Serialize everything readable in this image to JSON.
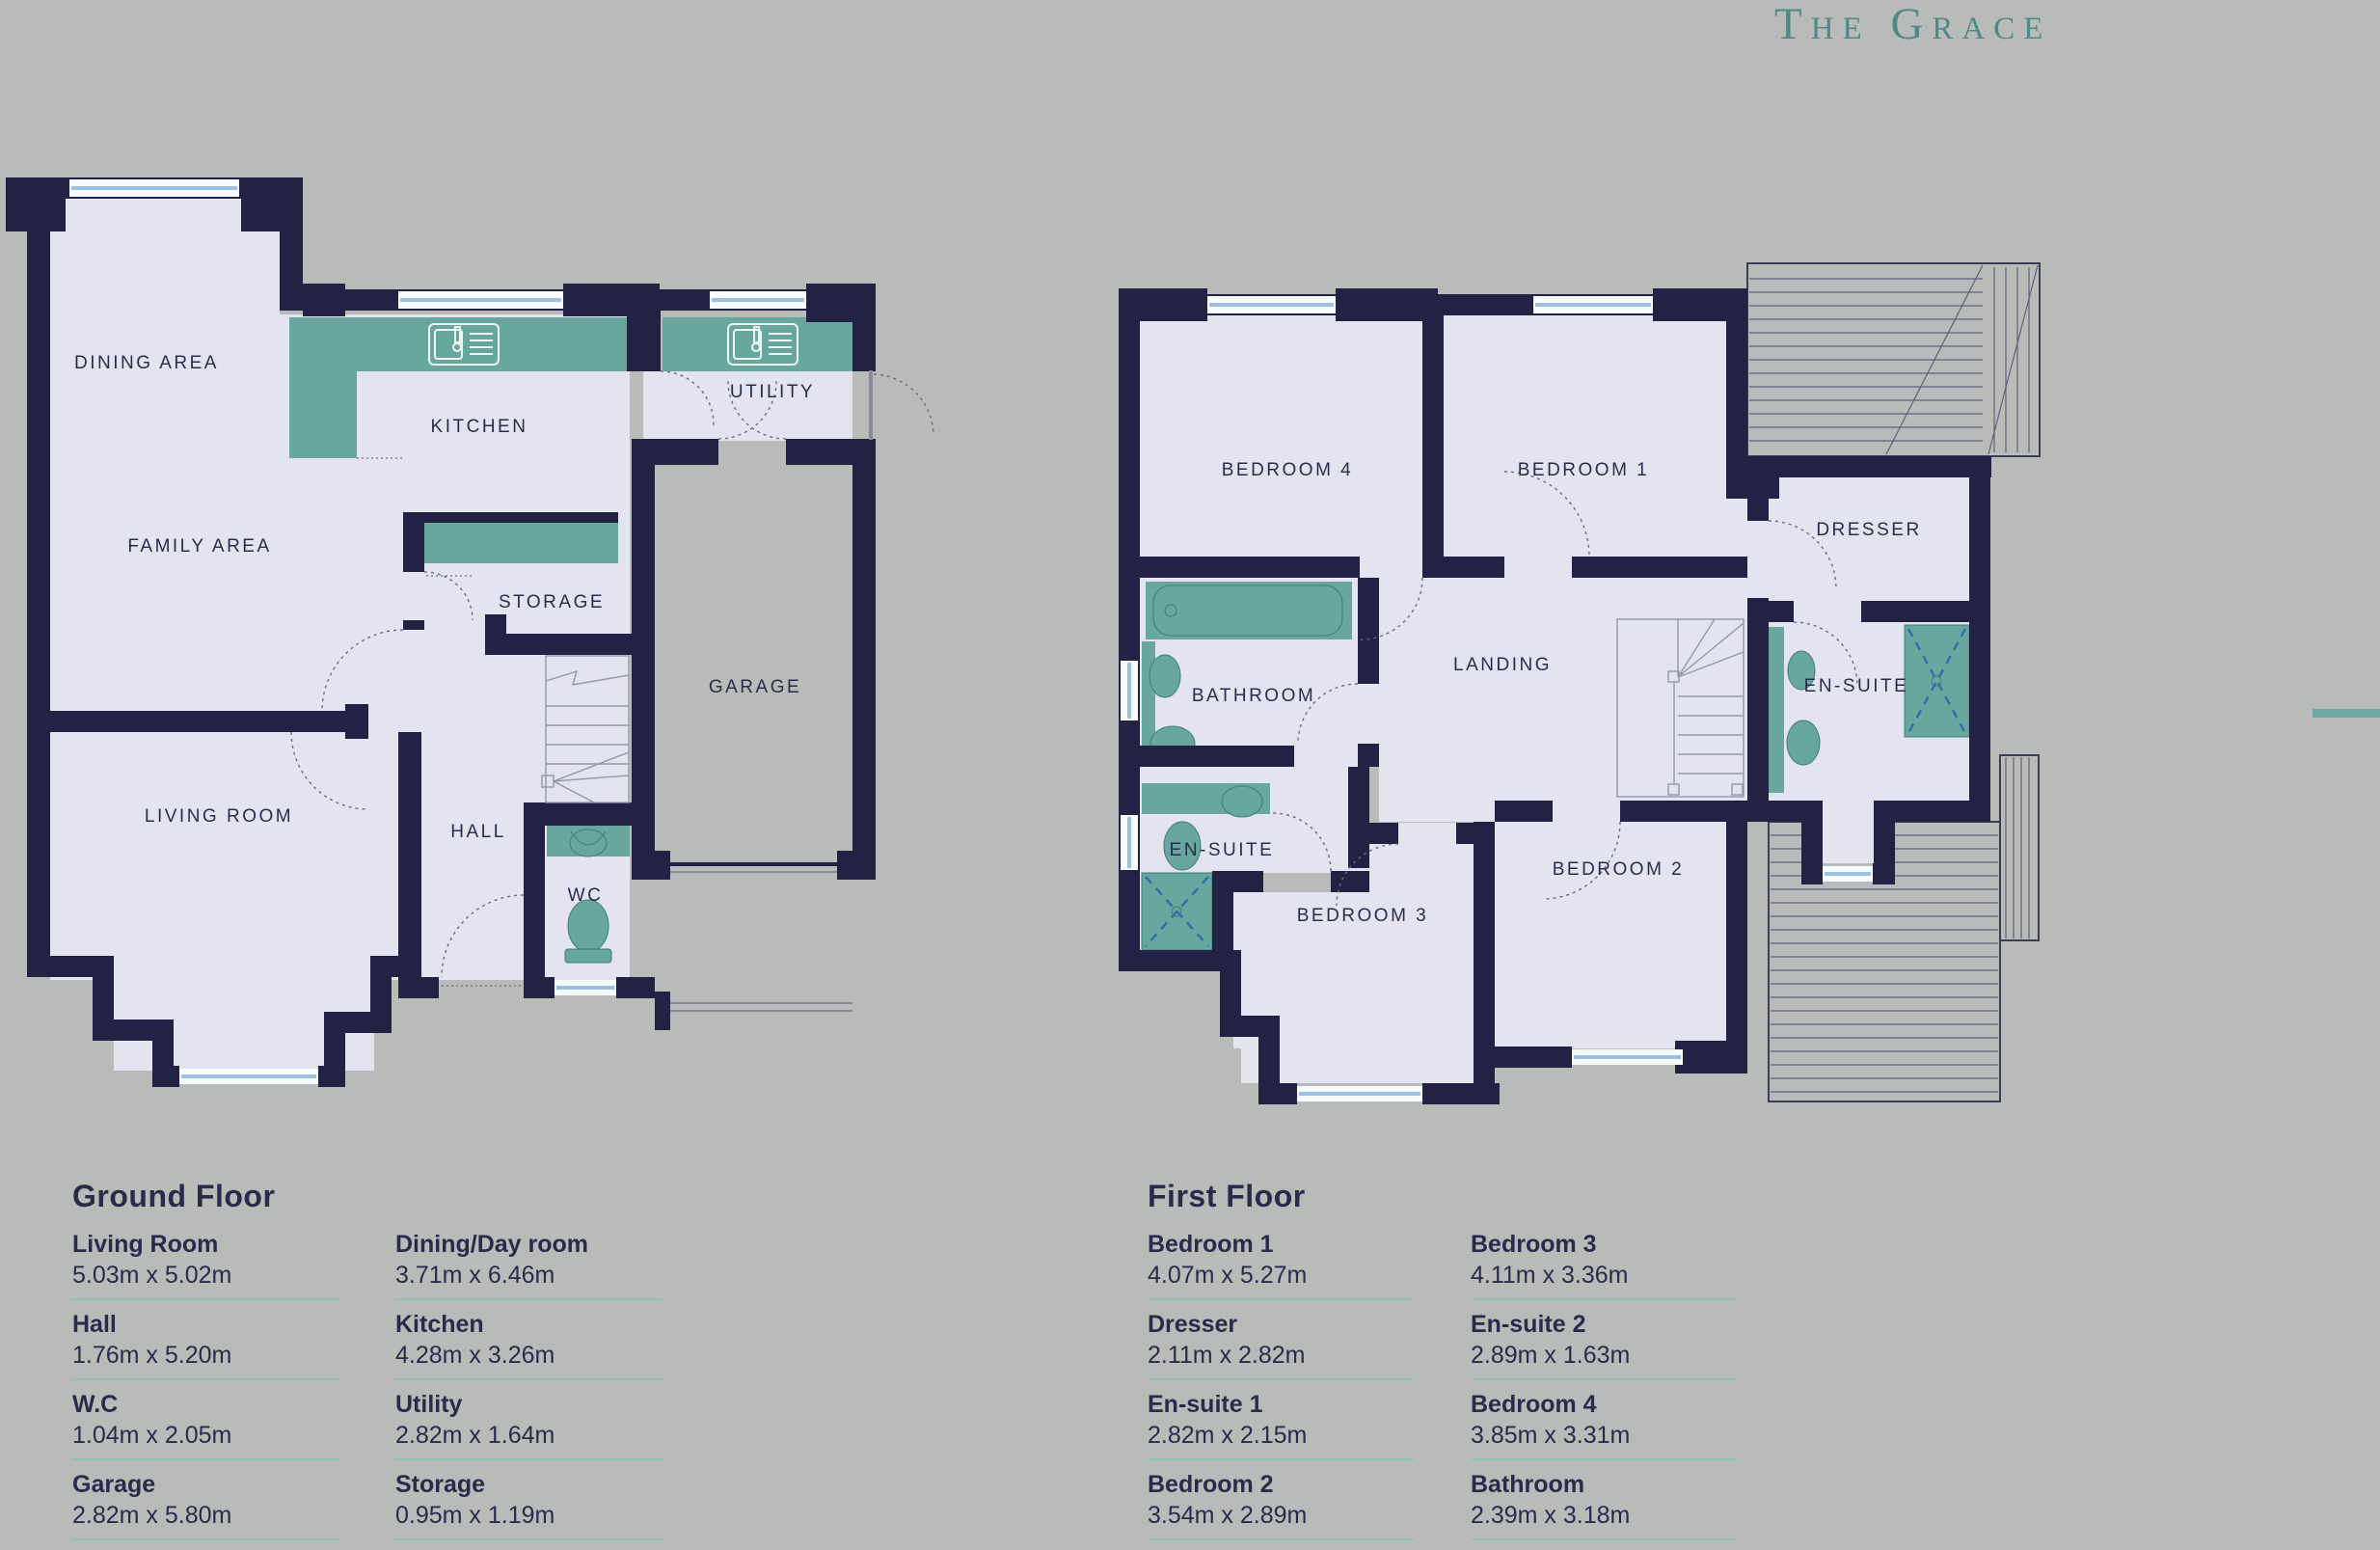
{
  "title": "The Grace",
  "colors": {
    "background": "#b9bbb9",
    "wall_navy": "#232244",
    "room_fill": "#e4e4f0",
    "accent_teal": "#68a79e",
    "title_teal": "#4d8a86",
    "text_navy": "#2a2a4b",
    "separator_teal": "#93c2bc",
    "window_blue": "#9cc0e2"
  },
  "plans": {
    "ground": {
      "labels": {
        "dining": "DINING AREA",
        "kitchen": "KITCHEN",
        "utility": "UTILITY",
        "family": "FAMILY AREA",
        "storage": "STORAGE",
        "garage": "GARAGE",
        "living": "LIVING ROOM",
        "hall": "HALL",
        "wc": "WC"
      }
    },
    "first": {
      "labels": {
        "bed4": "BEDROOM 4",
        "bed1": "BEDROOM 1",
        "dresser": "DRESSER",
        "bathroom": "BATHROOM",
        "landing": "LANDING",
        "ensuite_right": "EN-SUITE",
        "ensuite_left": "EN-SUITE",
        "bed3": "BEDROOM 3",
        "bed2": "BEDROOM 2"
      }
    }
  },
  "tables": {
    "ground": {
      "heading": "Ground Floor",
      "col1": [
        {
          "name": "Living Room",
          "dims": "5.03m x 5.02m"
        },
        {
          "name": "Hall",
          "dims": "1.76m x 5.20m"
        },
        {
          "name": "W.C",
          "dims": "1.04m x 2.05m"
        },
        {
          "name": "Garage",
          "dims": "2.82m x 5.80m"
        }
      ],
      "col2": [
        {
          "name": "Dining/Day room",
          "dims": "3.71m x 6.46m"
        },
        {
          "name": "Kitchen",
          "dims": "4.28m x 3.26m"
        },
        {
          "name": "Utility",
          "dims": "2.82m x 1.64m"
        },
        {
          "name": "Storage",
          "dims": "0.95m x 1.19m"
        }
      ]
    },
    "first": {
      "heading": "First Floor",
      "col1": [
        {
          "name": "Bedroom 1",
          "dims": "4.07m x 5.27m"
        },
        {
          "name": "Dresser",
          "dims": "2.11m x 2.82m"
        },
        {
          "name": "En-suite 1",
          "dims": "2.82m x 2.15m"
        },
        {
          "name": "Bedroom 2",
          "dims": "3.54m x 2.89m"
        }
      ],
      "col2": [
        {
          "name": "Bedroom 3",
          "dims": "4.11m x 3.36m"
        },
        {
          "name": "En-suite 2",
          "dims": "2.89m x 1.63m"
        },
        {
          "name": "Bedroom 4",
          "dims": "3.85m x 3.31m"
        },
        {
          "name": "Bathroom",
          "dims": "2.39m x 3.18m"
        }
      ]
    }
  }
}
